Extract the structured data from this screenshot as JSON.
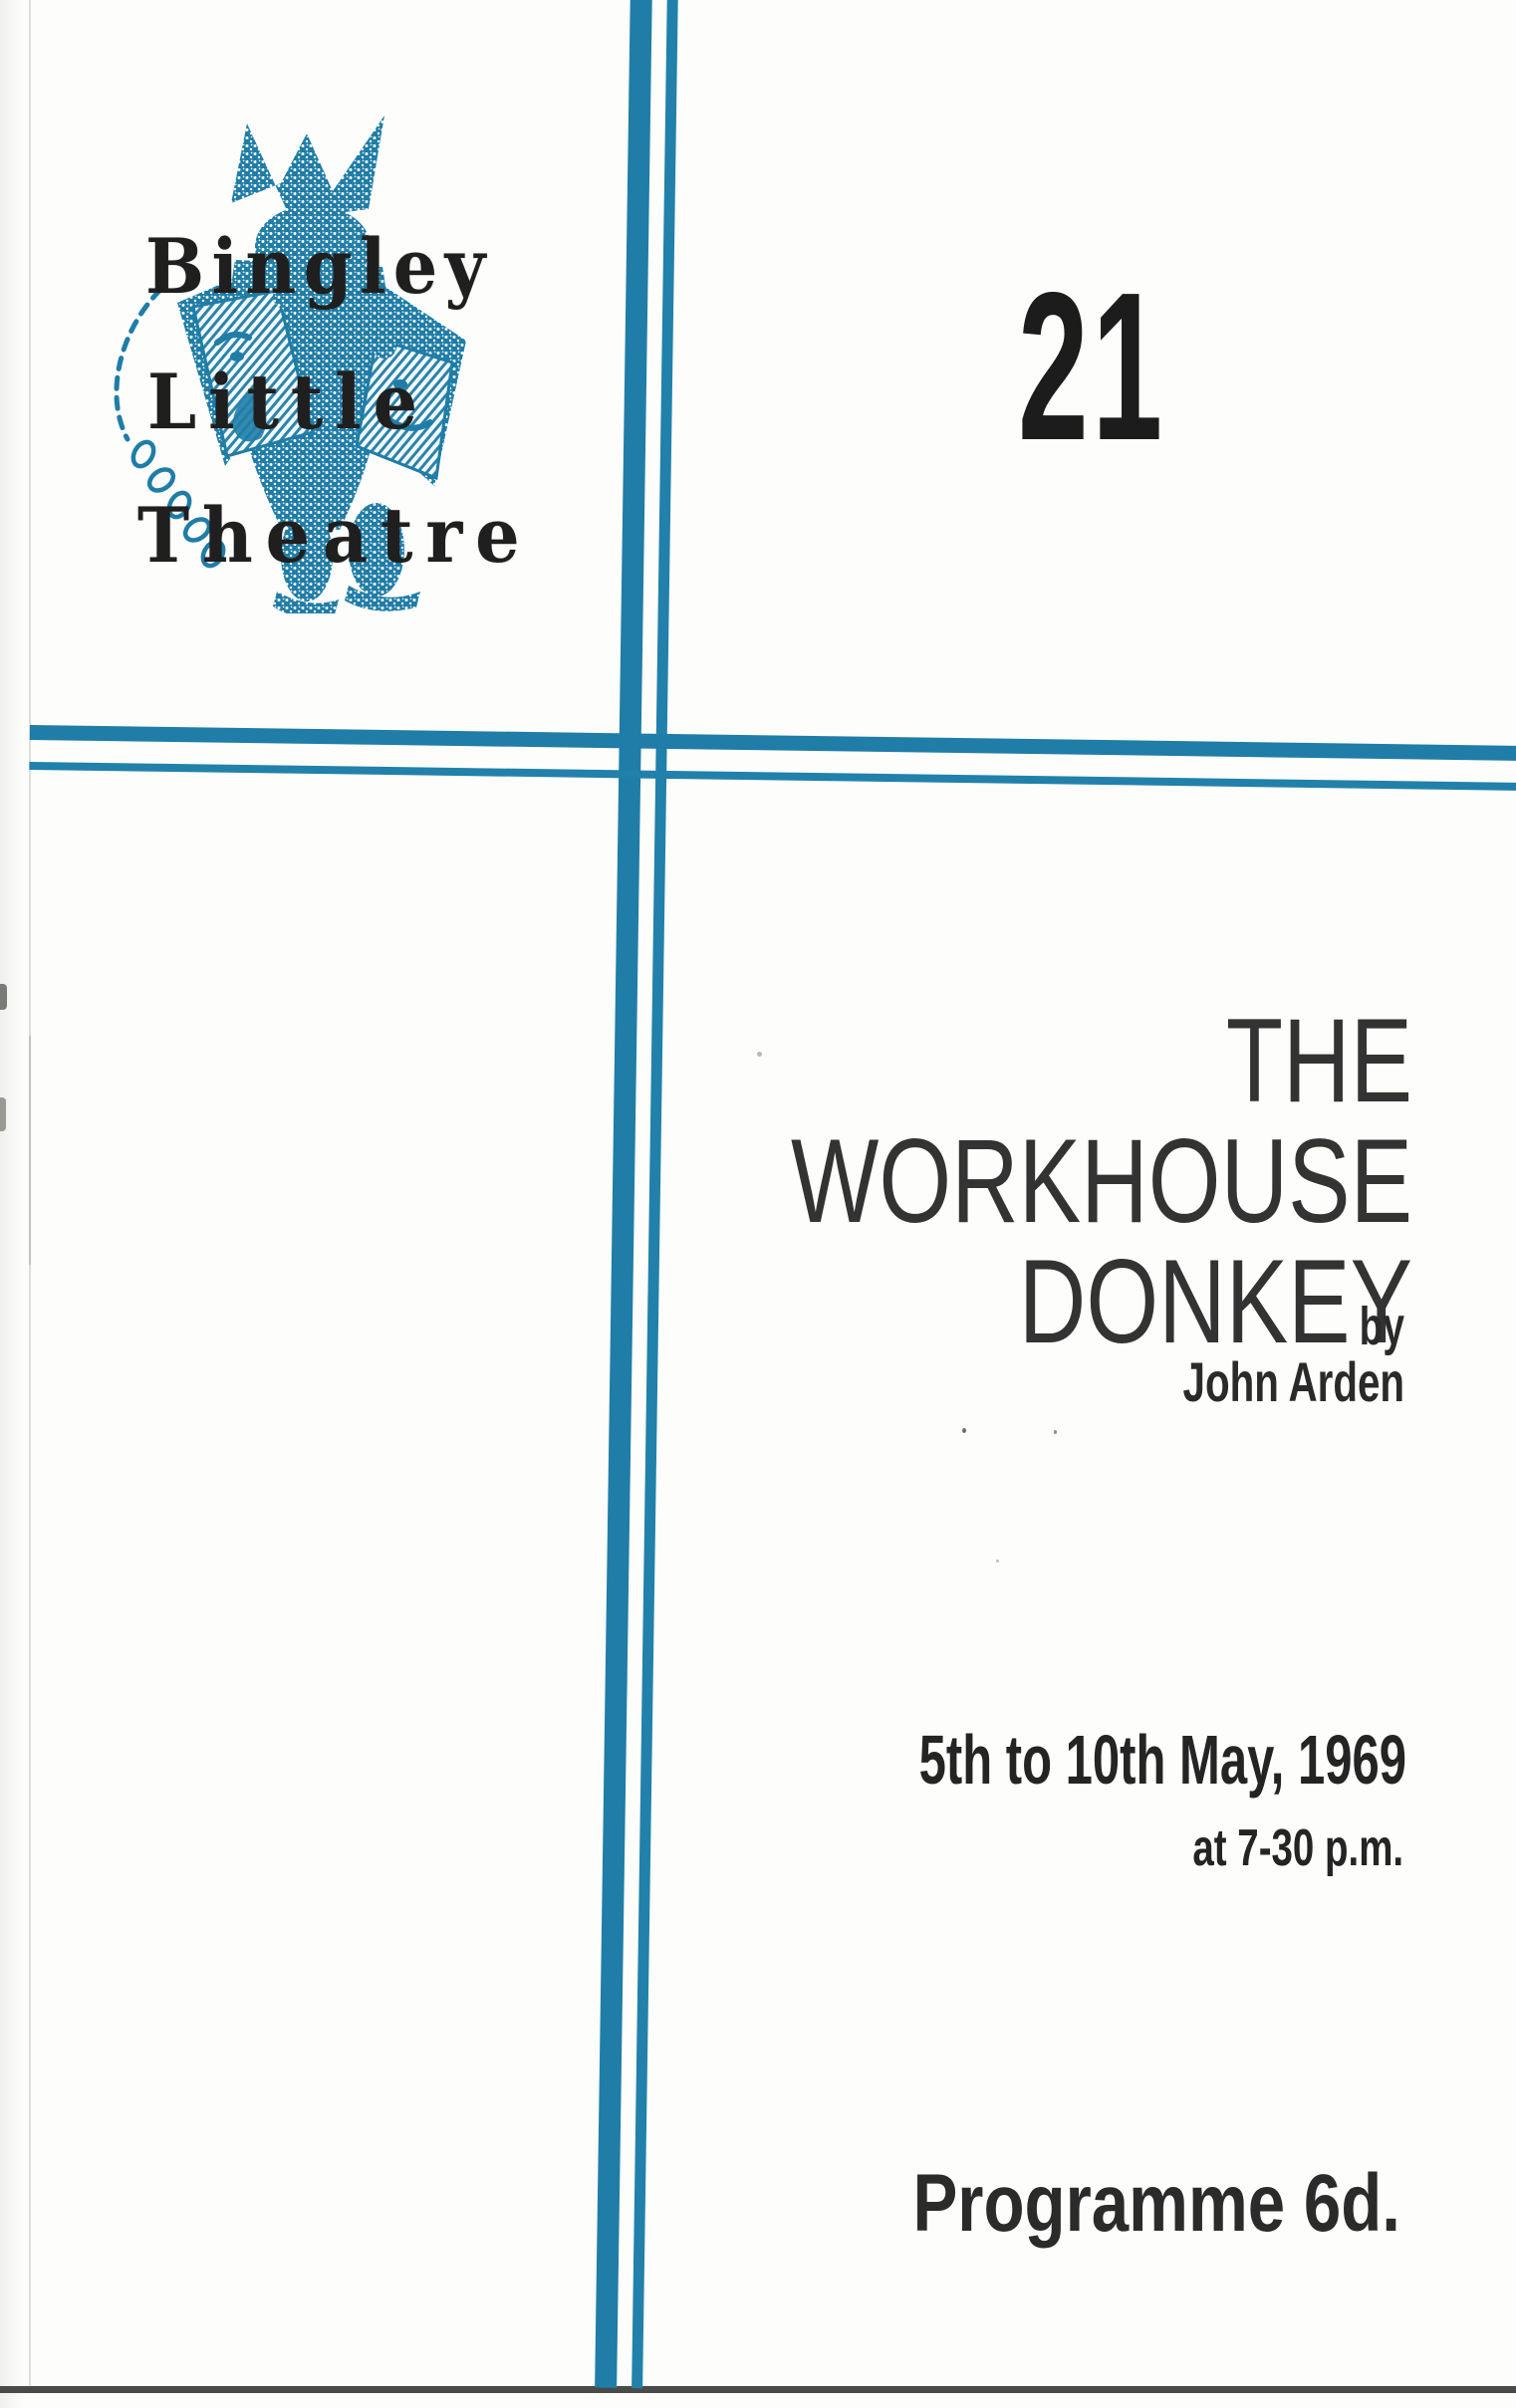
{
  "document": {
    "kind": "theatre programme front cover"
  },
  "logo": {
    "icon": "jester-with-comedy-tragedy-masks",
    "words": [
      "Bingley",
      "Little",
      "Theatre"
    ]
  },
  "issue_number": "21",
  "title": {
    "lines": [
      "THE",
      "WORKHOUSE",
      "DONKEY"
    ]
  },
  "byline": {
    "prefix": "by",
    "author": "John Arden"
  },
  "performance": {
    "dates": "5th to 10th May, 1969",
    "time": "at 7-30 p.m."
  },
  "price_label": "Programme 6d.",
  "colors": {
    "teal": "#1f7da7",
    "ink": "#222222",
    "paper": "#fdfdfb"
  }
}
